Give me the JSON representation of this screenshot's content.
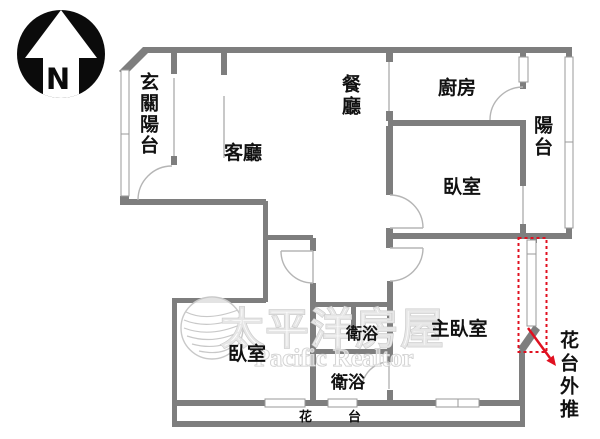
{
  "compass": {
    "north_label": "N"
  },
  "rooms": {
    "entry_balcony": "玄關陽台",
    "living_room": "客廳",
    "dining_room": "餐廳",
    "kitchen": "廚房",
    "balcony": "陽台",
    "bedroom_upper": "臥室",
    "master_bedroom": "主臥室",
    "bath_upper": "衛浴",
    "bath_lower": "衛浴",
    "bedroom_lower": "臥室",
    "flower_bed": "花台",
    "flower_bed_pushout": "花台外推"
  },
  "watermark": {
    "brand_cn": "太平洋房屋",
    "brand_en": "Pacific Realtor"
  },
  "colors": {
    "wall": "#7e7e7e",
    "annotation_red": "#e01020",
    "watermark_gray": "#c8c8c8"
  }
}
